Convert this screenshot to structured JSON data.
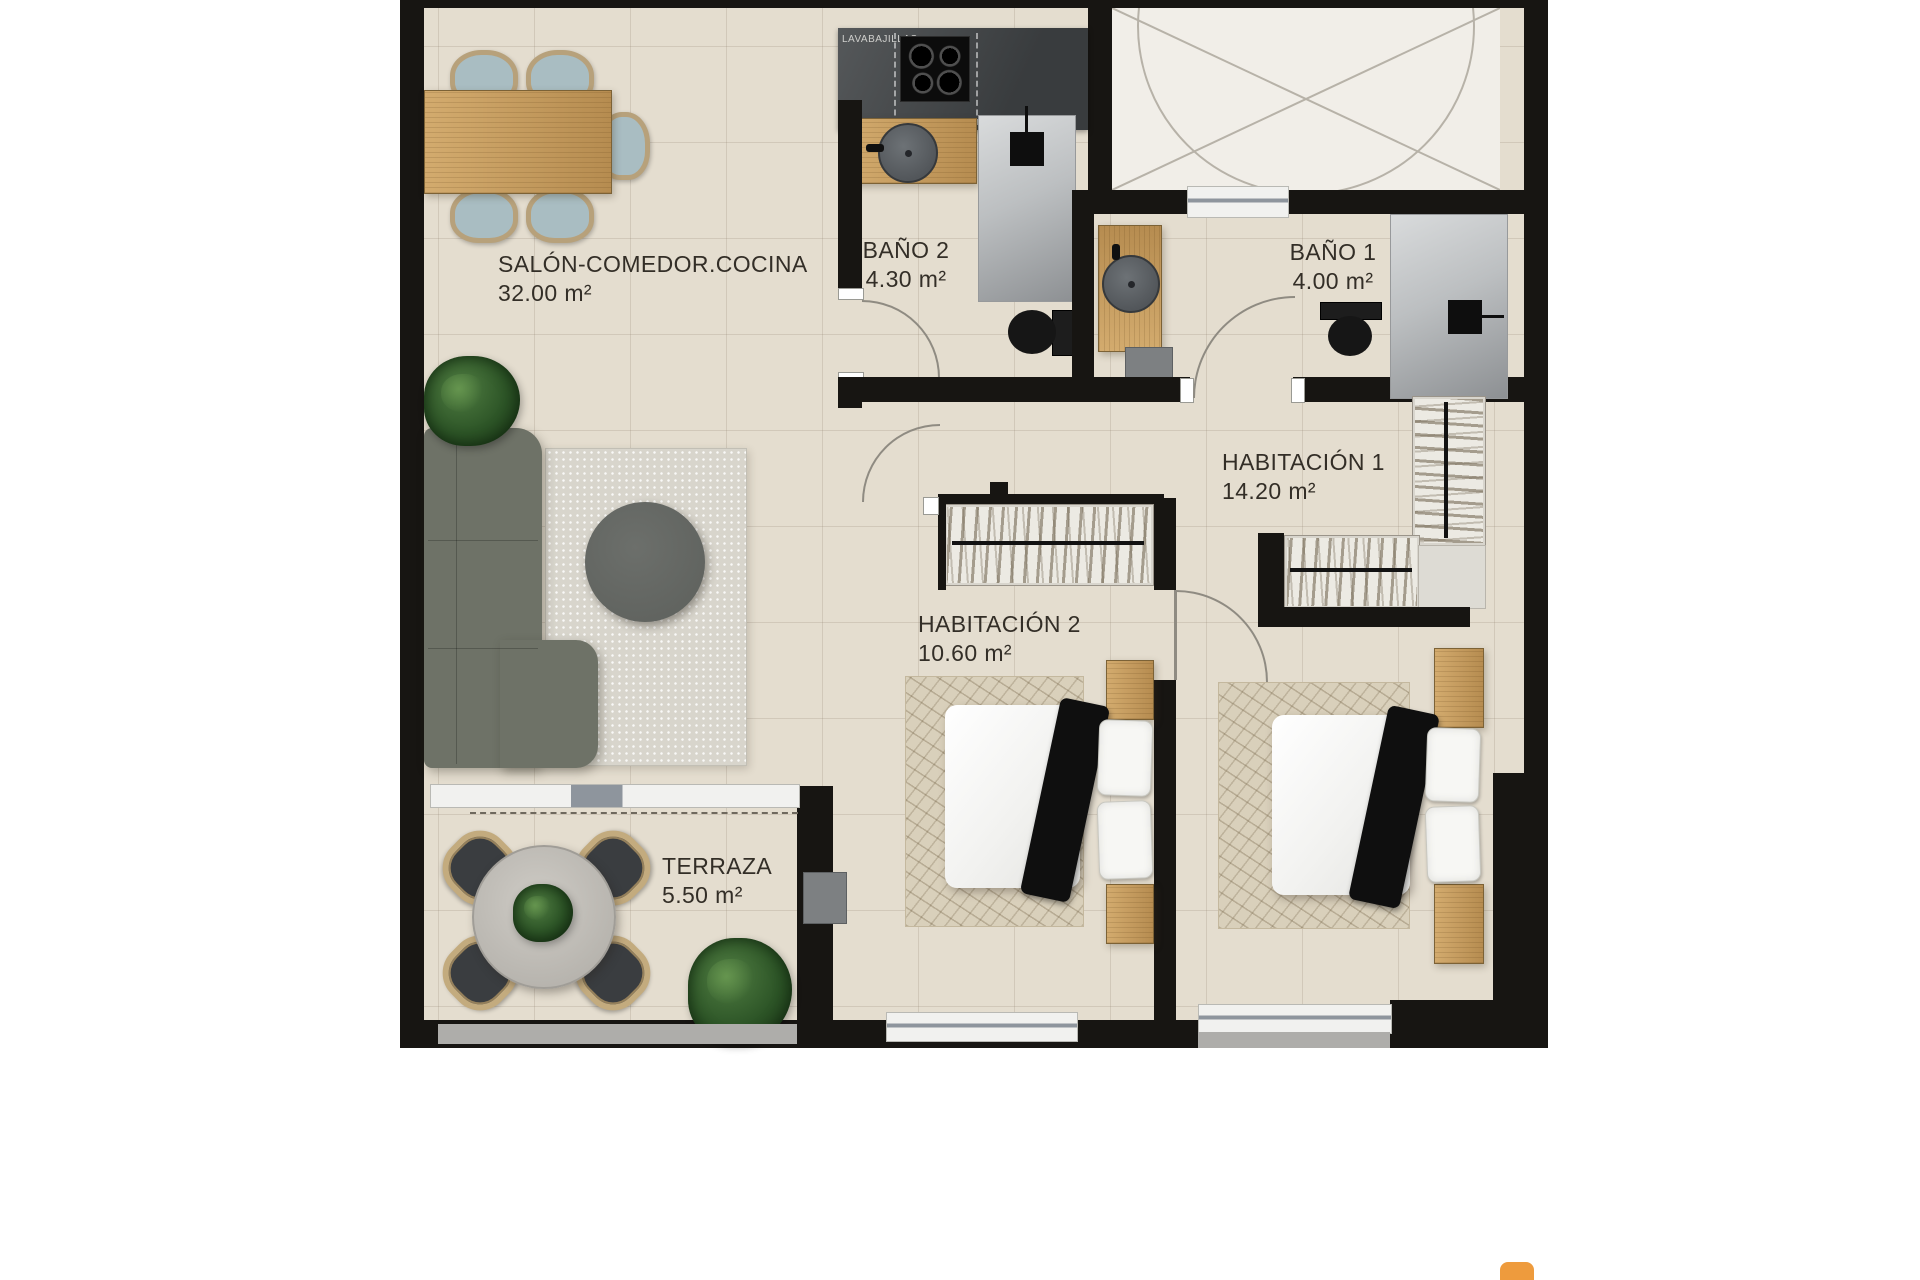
{
  "plan": {
    "rooms": [
      {
        "id": "salon",
        "name": "SALÓN-COMEDOR.COCINA",
        "area": "32.00 m²"
      },
      {
        "id": "bano2",
        "name": "BAÑO 2",
        "area": "4.30 m²"
      },
      {
        "id": "bano1",
        "name": "BAÑO 1",
        "area": "4.00 m²"
      },
      {
        "id": "hab1",
        "name": "HABITACIÓN 1",
        "area": "14.20 m²"
      },
      {
        "id": "hab2",
        "name": "HABITACIÓN 2",
        "area": "10.60 m²"
      },
      {
        "id": "terraza",
        "name": "TERRAZA",
        "area": "5.50 m²"
      }
    ],
    "kitchen": {
      "appliance_label": "LAVABAJILLAS"
    },
    "colors": {
      "wall": "#171512",
      "floor_tile": "#e4ddcf",
      "void_room": "#f1eee8",
      "wood": "#c9a265",
      "kitchen_counter": "#46494b",
      "sofa": "#6e7267",
      "shower": "#b0b3b5",
      "fixture_black": "#161616",
      "logo_accent": "#ee9b3d"
    }
  }
}
